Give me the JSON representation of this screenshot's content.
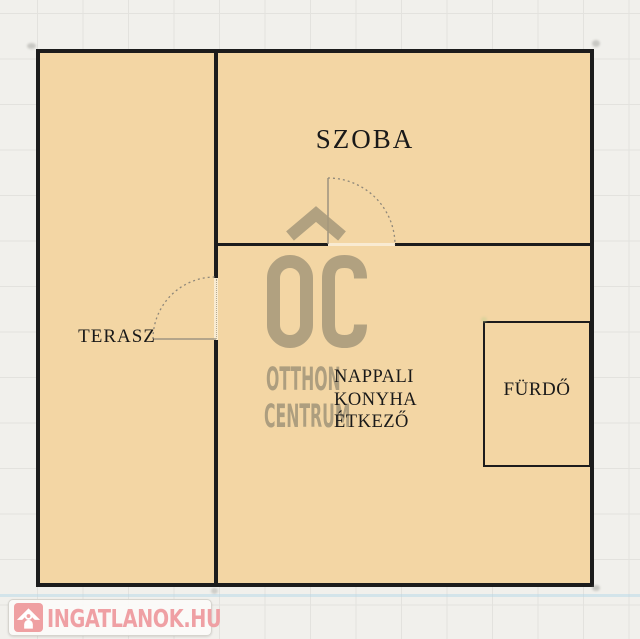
{
  "floorplan": {
    "rooms": {
      "szoba": "SZOBA",
      "terasz": "TERASZ",
      "nappali_lines": [
        "NAPPALI",
        "KONYHA",
        "ÉTKEZŐ"
      ],
      "furdo": "FÜRDŐ"
    }
  },
  "watermark": {
    "monogram": "OC",
    "name_line1": "OTTHON",
    "name_line2": "CENTRUM",
    "color": "#a89a7c"
  },
  "logo": {
    "text": "INGATLANOK.HU",
    "icon": "house-icon",
    "color": "#efa0a4"
  },
  "colors": {
    "plan_fill": "#f3d6a4",
    "wall": "#1c1c1c",
    "background": "#f1f0ec",
    "grid_line": "#e3e2de",
    "door_line": "#8f887a"
  }
}
